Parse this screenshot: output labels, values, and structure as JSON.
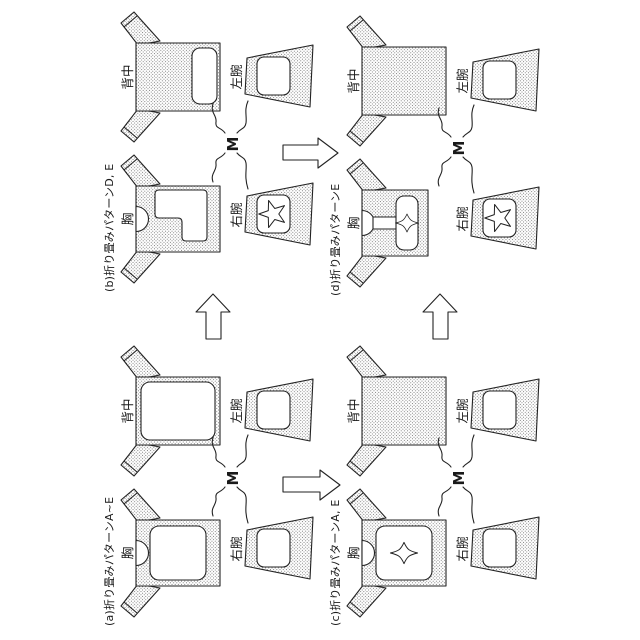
{
  "figure": {
    "type": "patent-folding-pattern-diagram",
    "orientation": "rotated-90-ccw",
    "colors": {
      "paper": "#ffffff",
      "outline": "#222222",
      "stipple_dot": "#4d4d4d",
      "print_fill": "#ffffff"
    },
    "panels": [
      {
        "key": "a",
        "label": "(a)折り畳みパターンA~E",
        "front_label": "胸",
        "back_label": "背中",
        "right_arm_label": "右腕",
        "left_arm_label": "左腕",
        "size_label": "M",
        "front_print": "large-rounded-rect",
        "back_print": "large-rounded-rect",
        "front_star": false,
        "right_arm_star": false
      },
      {
        "key": "b",
        "label": "(b)折り畳みパターンD, E",
        "front_label": "胸",
        "back_label": "背中",
        "right_arm_label": "右腕",
        "left_arm_label": "左腕",
        "size_label": "M",
        "front_print": "L-shape",
        "back_print": "bottom-wide-rect",
        "front_star": false,
        "right_arm_star": true
      },
      {
        "key": "c",
        "label": "(c)折り畳みパターンA, E",
        "front_label": "胸",
        "back_label": "背中",
        "right_arm_label": "右腕",
        "left_arm_label": "左腕",
        "size_label": "M",
        "front_print": "rounded-rect-with-4point-star",
        "back_print": "none",
        "front_star": true,
        "right_arm_star": false
      },
      {
        "key": "d",
        "label": "(d)折り畳みパターンE",
        "front_label": "胸",
        "back_label": "背中",
        "right_arm_label": "右腕",
        "left_arm_label": "左腕",
        "size_label": "M",
        "front_print": "collar-bar-and-rect-with-4point-star",
        "back_print": "none",
        "front_star": true,
        "right_arm_star": true
      }
    ],
    "arrows": [
      {
        "name": "arrow-a-to-b",
        "direction": "right"
      },
      {
        "name": "arrow-c-to-d",
        "direction": "right"
      },
      {
        "name": "arrow-b-to-d",
        "direction": "down"
      },
      {
        "name": "arrow-a-to-c",
        "direction": "down"
      }
    ]
  }
}
